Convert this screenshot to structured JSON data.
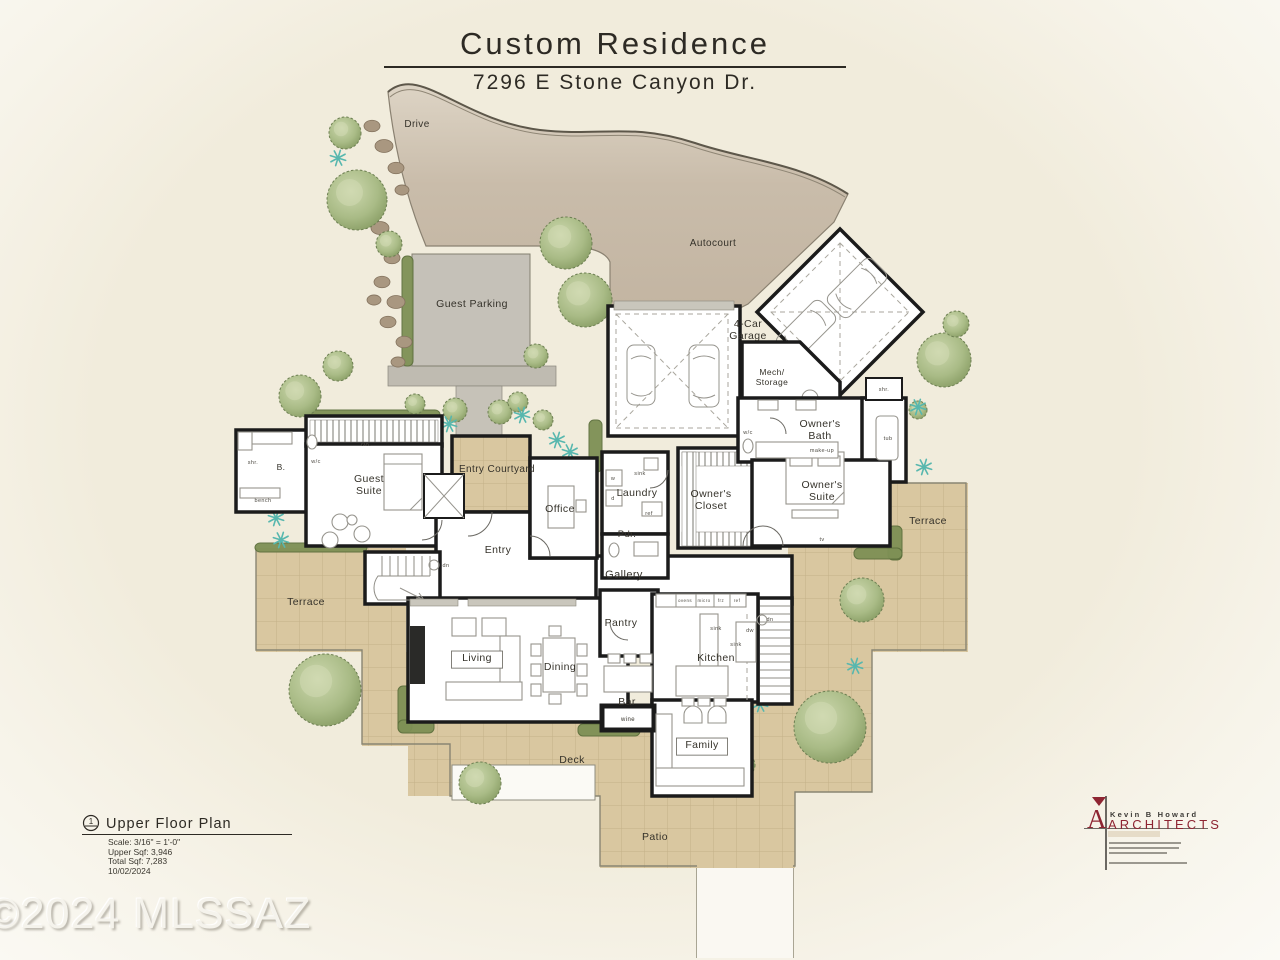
{
  "title": {
    "name": "Custom Residence",
    "address": "7296 E Stone Canyon Dr."
  },
  "title_block": {
    "plan_name": "Upper Floor Plan",
    "marker": "1",
    "scale": "Scale: 3/16\" = 1'-0\"",
    "upper_sqft": "Upper Sqf: 3,946",
    "total_sqft": "Total Sqf: 7,283",
    "date": "10/02/2024"
  },
  "watermark": "©2024 MLSSAZ",
  "architect": {
    "name": "Kevin B Howard",
    "firm": "ARCHITECTS",
    "accent_color": "#8e2532"
  },
  "colors": {
    "background_cream": "#f1ecdc",
    "drive_tan": "#c7baa8",
    "tile_tan": "#d9c7a0",
    "parking_gray": "#c5c1b8",
    "wall_black": "#1b1b1b",
    "tree_green": "#9cb07c",
    "agave_teal": "#57b7ae",
    "logo_red": "#8e2532"
  },
  "plan": {
    "labels": [
      {
        "t": "Drive",
        "x": 417,
        "y": 127,
        "fs": 10
      },
      {
        "t": "Autocourt",
        "x": 713,
        "y": 246,
        "fs": 10
      },
      {
        "t": "Guest Parking",
        "x": 472,
        "y": 307,
        "fs": 10.5
      },
      {
        "t": "4-Car\nGarage",
        "x": 748,
        "y": 327,
        "fs": 10.5
      },
      {
        "t": "Mech/\nStorage",
        "x": 772,
        "y": 375,
        "fs": 8.5
      },
      {
        "t": "Entry Courtyard",
        "x": 497,
        "y": 472,
        "fs": 10
      },
      {
        "t": "Guest\nSuite",
        "x": 369,
        "y": 482,
        "fs": 10.5
      },
      {
        "t": "B.",
        "x": 281,
        "y": 470,
        "fs": 8.5
      },
      {
        "t": "Office",
        "x": 560,
        "y": 512,
        "fs": 10.5
      },
      {
        "t": "Entry",
        "x": 498,
        "y": 553,
        "fs": 10.5
      },
      {
        "t": "Laundry",
        "x": 637,
        "y": 496,
        "fs": 10.5
      },
      {
        "t": "Pdr.",
        "x": 627,
        "y": 537,
        "fs": 9.5
      },
      {
        "t": "Gallery",
        "x": 624,
        "y": 578,
        "fs": 11
      },
      {
        "t": "Owner's\nCloset",
        "x": 711,
        "y": 497,
        "fs": 10.5
      },
      {
        "t": "Owner's\nBath",
        "x": 820,
        "y": 427,
        "fs": 10.5
      },
      {
        "t": "Owner's\nSuite",
        "x": 822,
        "y": 488,
        "fs": 10.5
      },
      {
        "t": "Terrace",
        "x": 306,
        "y": 605,
        "fs": 10.5
      },
      {
        "t": "Terrace",
        "x": 928,
        "y": 524,
        "fs": 10.5
      },
      {
        "t": "Living",
        "x": 477,
        "y": 661,
        "fs": 10.5,
        "boxed": true
      },
      {
        "t": "Dining",
        "x": 560,
        "y": 670,
        "fs": 10.5
      },
      {
        "t": "Pantry",
        "x": 621,
        "y": 626,
        "fs": 10.5
      },
      {
        "t": "Kitchen",
        "x": 716,
        "y": 661,
        "fs": 10.5
      },
      {
        "t": "Bar",
        "x": 627,
        "y": 705,
        "fs": 10.5
      },
      {
        "t": "Family",
        "x": 702,
        "y": 748,
        "fs": 10.5,
        "boxed": true
      },
      {
        "t": "Deck",
        "x": 572,
        "y": 763,
        "fs": 10.5
      },
      {
        "t": "Patio",
        "x": 655,
        "y": 840,
        "fs": 10.5
      },
      {
        "t": "wine",
        "x": 628,
        "y": 721,
        "fs": 6
      }
    ],
    "fixtures": [
      {
        "t": "clo.",
        "x": 366,
        "y": 446
      },
      {
        "t": "shr.",
        "x": 253,
        "y": 464
      },
      {
        "t": "w/c",
        "x": 316,
        "y": 463
      },
      {
        "t": "bench",
        "x": 263,
        "y": 502
      },
      {
        "t": "dn",
        "x": 446,
        "y": 567
      },
      {
        "t": "dn",
        "x": 770,
        "y": 621
      },
      {
        "t": "sink",
        "x": 640,
        "y": 475
      },
      {
        "t": "w",
        "x": 613,
        "y": 480
      },
      {
        "t": "d",
        "x": 613,
        "y": 500
      },
      {
        "t": "ref",
        "x": 649,
        "y": 515
      },
      {
        "t": "w/c",
        "x": 748,
        "y": 434
      },
      {
        "t": "make-up",
        "x": 822,
        "y": 452
      },
      {
        "t": "tub",
        "x": 888,
        "y": 440
      },
      {
        "t": "shr.",
        "x": 884,
        "y": 391
      },
      {
        "t": "tv",
        "x": 822,
        "y": 541
      },
      {
        "t": "ovens",
        "x": 685,
        "y": 602,
        "fs": 4.5
      },
      {
        "t": "micro",
        "x": 704,
        "y": 602,
        "fs": 4.5
      },
      {
        "t": "frz",
        "x": 721,
        "y": 602,
        "fs": 4.5
      },
      {
        "t": "ref",
        "x": 737,
        "y": 602,
        "fs": 4.5
      },
      {
        "t": "sink",
        "x": 716,
        "y": 630
      },
      {
        "t": "dw",
        "x": 750,
        "y": 632
      },
      {
        "t": "sink",
        "x": 736,
        "y": 646
      }
    ],
    "landscape": {
      "trees": [
        [
          345,
          133,
          16
        ],
        [
          357,
          200,
          30
        ],
        [
          389,
          244,
          13
        ],
        [
          300,
          396,
          21
        ],
        [
          338,
          366,
          15
        ],
        [
          566,
          243,
          26
        ],
        [
          585,
          300,
          27
        ],
        [
          536,
          356,
          12
        ],
        [
          415,
          404,
          10
        ],
        [
          455,
          410,
          12
        ],
        [
          500,
          412,
          12
        ],
        [
          518,
          402,
          10
        ],
        [
          543,
          420,
          10
        ],
        [
          621,
          424,
          9
        ],
        [
          944,
          360,
          27
        ],
        [
          956,
          324,
          13
        ],
        [
          918,
          410,
          9
        ],
        [
          862,
          600,
          22
        ],
        [
          830,
          727,
          36
        ],
        [
          325,
          690,
          36
        ],
        [
          480,
          783,
          21
        ],
        [
          744,
          765,
          11
        ]
      ],
      "agaves": [
        [
          338,
          158
        ],
        [
          276,
          518
        ],
        [
          281,
          540
        ],
        [
          449,
          424
        ],
        [
          522,
          415
        ],
        [
          557,
          440
        ],
        [
          570,
          452
        ],
        [
          643,
          425
        ],
        [
          918,
          407
        ],
        [
          924,
          467
        ],
        [
          855,
          666
        ],
        [
          760,
          704
        ]
      ],
      "rocks": [
        [
          372,
          126,
          8
        ],
        [
          384,
          146,
          9
        ],
        [
          396,
          168,
          8
        ],
        [
          402,
          190,
          7
        ],
        [
          380,
          228,
          9
        ],
        [
          392,
          258,
          8
        ],
        [
          382,
          282,
          8
        ],
        [
          396,
          302,
          9
        ],
        [
          374,
          300,
          7
        ],
        [
          388,
          322,
          8
        ],
        [
          404,
          342,
          8
        ],
        [
          398,
          362,
          7
        ]
      ],
      "hedges": [
        [
          402,
          256,
          11,
          110
        ],
        [
          255,
          543,
          112,
          9
        ],
        [
          306,
          410,
          134,
          9
        ],
        [
          589,
          420,
          13,
          52
        ],
        [
          398,
          686,
          14,
          46
        ],
        [
          398,
          720,
          36,
          13
        ],
        [
          578,
          724,
          62,
          12
        ],
        [
          888,
          526,
          14,
          34
        ],
        [
          854,
          548,
          48,
          11
        ]
      ]
    }
  }
}
